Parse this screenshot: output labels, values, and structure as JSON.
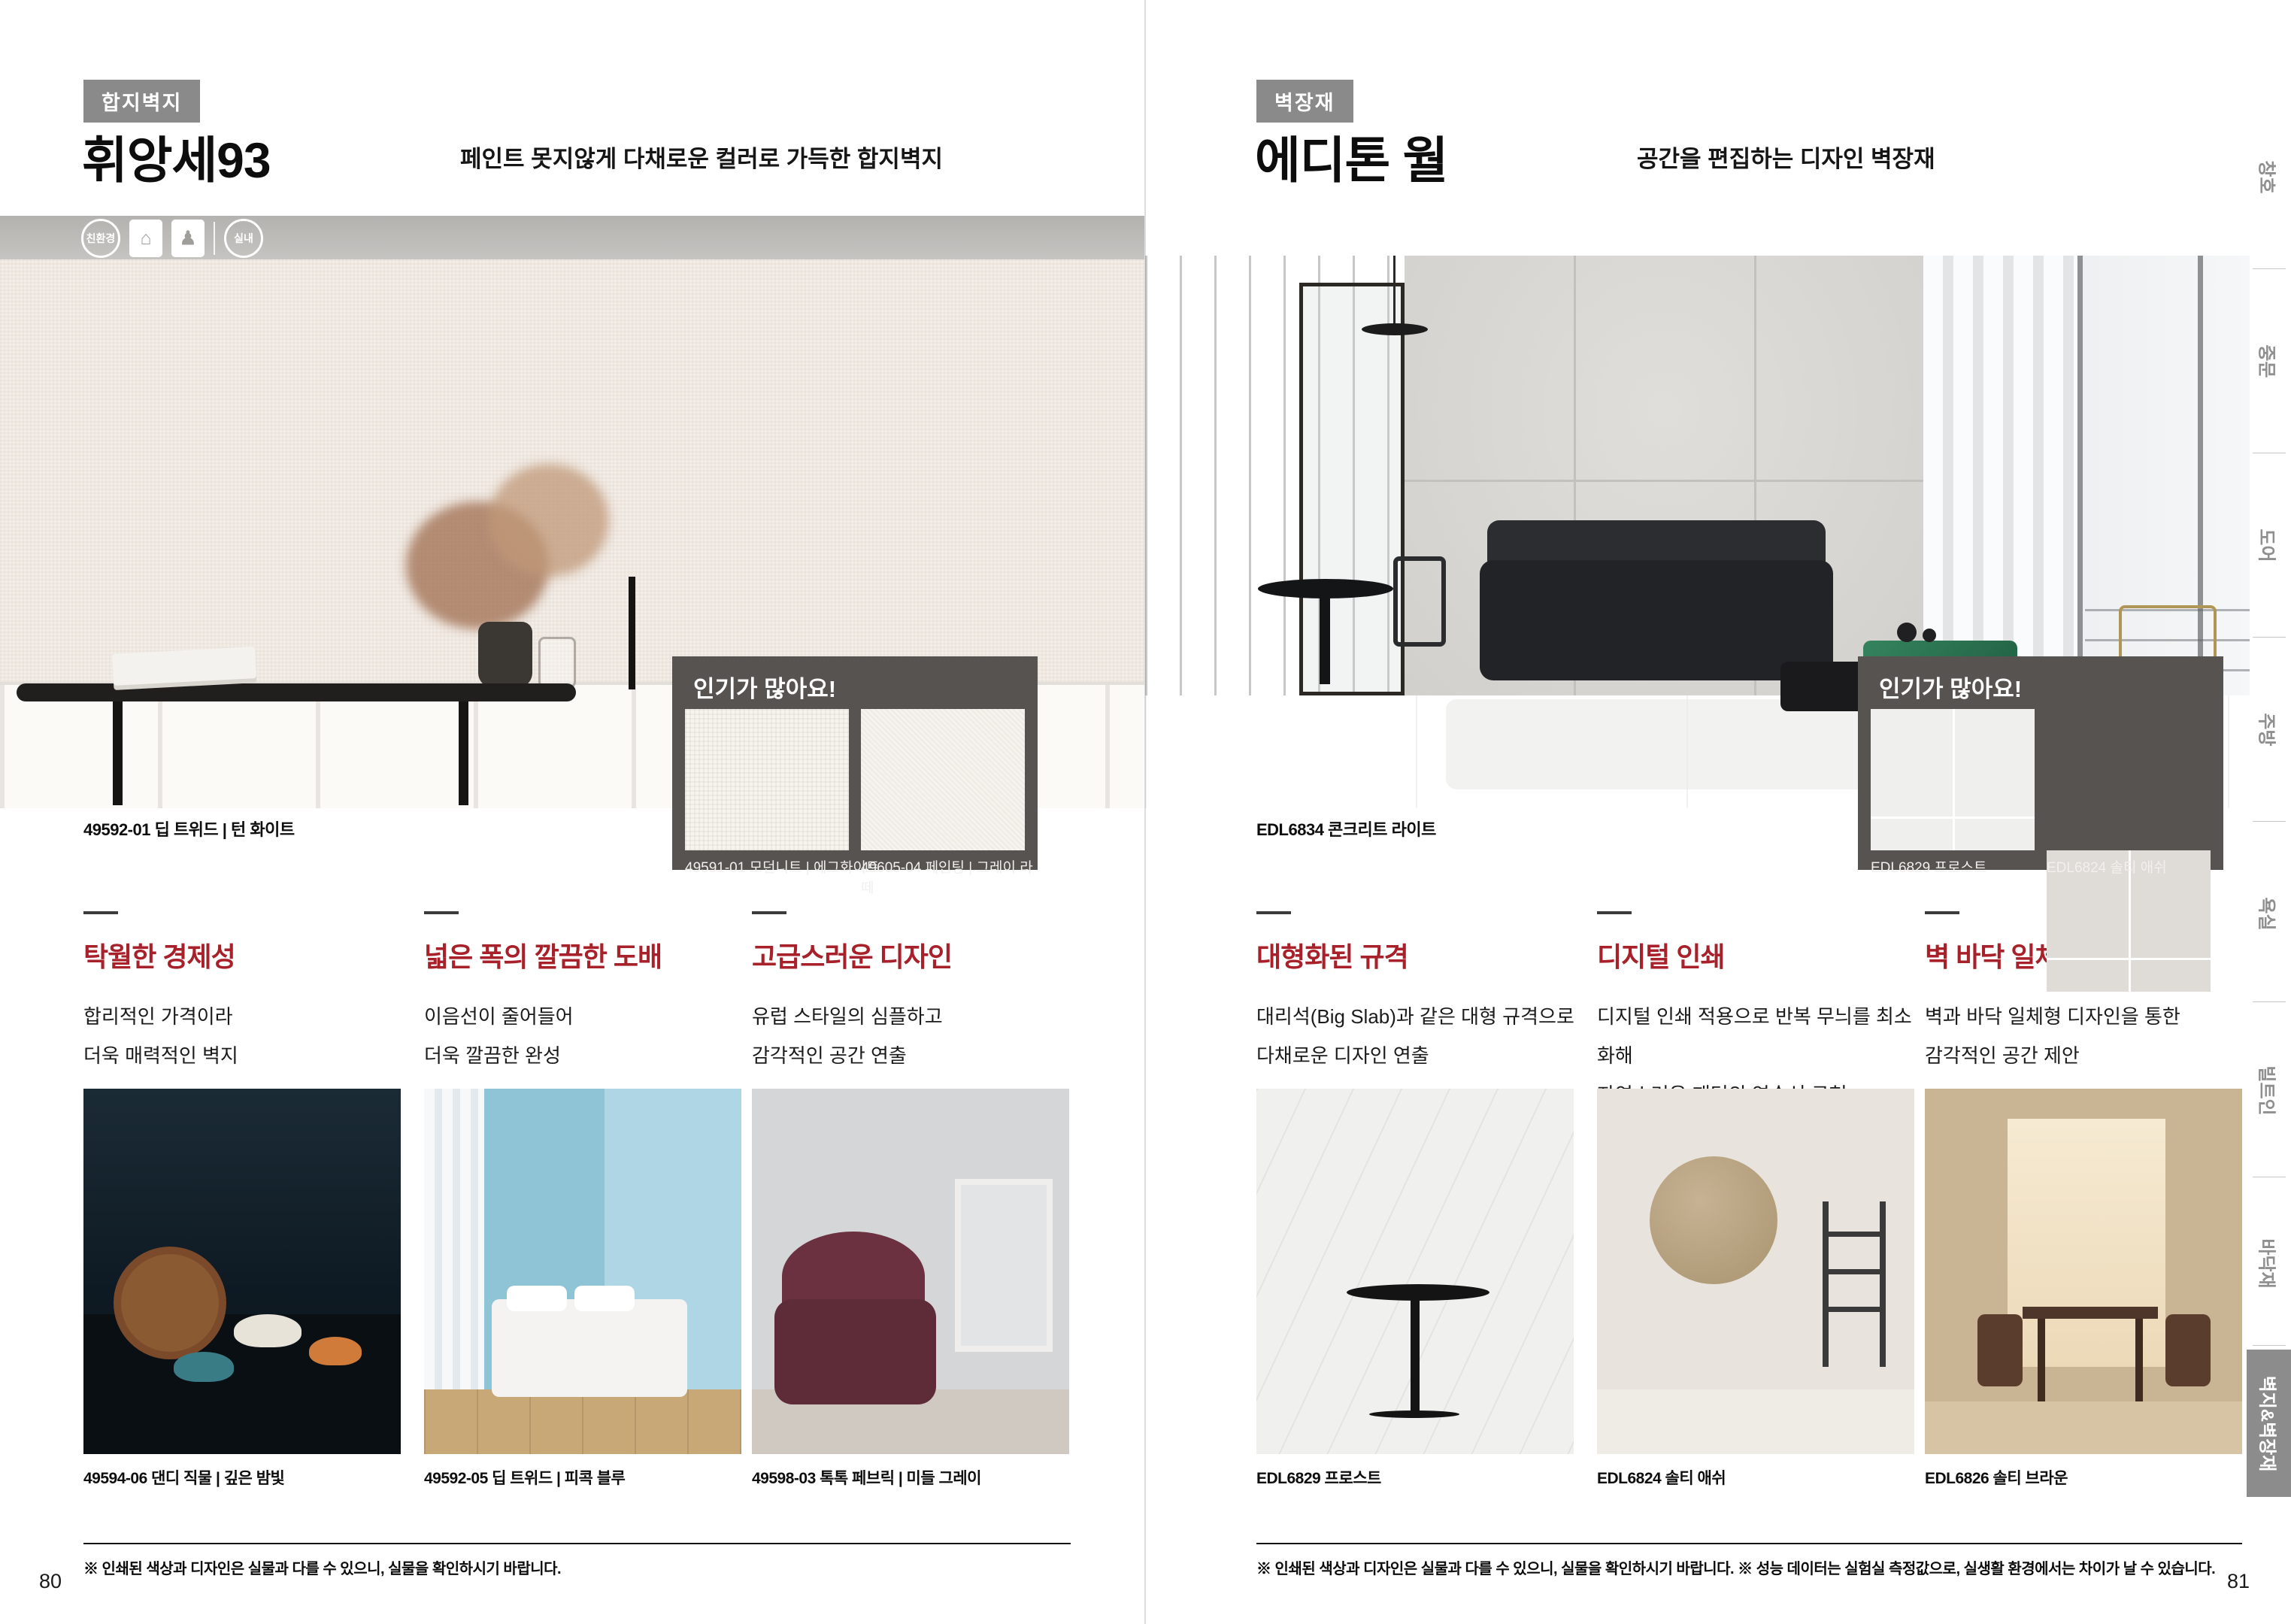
{
  "colors": {
    "accent_red": "#a8212a",
    "badge_gray": "#8a8a8a",
    "popular_box_bg": "#575350",
    "sidebar_active_bg": "#8c8c8c"
  },
  "icons": {
    "eco_house": "⌂",
    "care_person": "♟"
  },
  "pages": {
    "left": {
      "category_badge": "합지벽지",
      "title": "휘앙세93",
      "subtitle": "페인트 못지않게 다채로운 컬러로 가득한 합지벽지",
      "cert_badges": {
        "eco": "친환경",
        "indoor": "실내"
      },
      "hero_caption": "49592-01 딥 트위드 | 턴 화이트",
      "popular": {
        "title": "인기가 많아요!",
        "items": [
          {
            "label": "49591-01 모던니트 | 에그화이트"
          },
          {
            "label": "49605-04 페인팅 | 그레이 라떼"
          }
        ]
      },
      "features": [
        {
          "heading": "탁월한 경제성",
          "line1": "합리적인 가격이라",
          "line2": "더욱 매력적인 벽지"
        },
        {
          "heading": "넓은 폭의 깔끔한 도배",
          "line1": "이음선이 줄어들어",
          "line2": "더욱 깔끔한 완성"
        },
        {
          "heading": "고급스러운 디자인",
          "line1": "유럽 스타일의 심플하고",
          "line2": "감각적인 공간 연출"
        }
      ],
      "products": [
        {
          "caption": "49594-06 댄디 직물 | 깊은 밤빛"
        },
        {
          "caption": "49592-05 딥 트위드 | 피콕 블루"
        },
        {
          "caption": "49598-03 톡톡 페브릭 | 미들 그레이"
        }
      ],
      "footnote": "※ 인쇄된 색상과 디자인은 실물과 다를 수 있으니, 실물을 확인하시기 바랍니다.",
      "page_number": "80"
    },
    "right": {
      "category_badge": "벽장재",
      "title": "에디톤 월",
      "subtitle": "공간을 편집하는 디자인 벽장재",
      "hero_caption": "EDL6834 콘크리트 라이트",
      "popular": {
        "title": "인기가 많아요!",
        "items": [
          {
            "label": "EDL6829 프로스트"
          },
          {
            "label": "EDL6824 솔티 애쉬"
          }
        ]
      },
      "features": [
        {
          "heading": "대형화된 규격",
          "line1": "대리석(Big Slab)과 같은 대형 규격으로",
          "line2": "다채로운 디자인 연출"
        },
        {
          "heading": "디지털 인쇄",
          "line1": "디지털 인쇄 적용으로 반복 무늬를 최소화해",
          "line2": "자연스러운 패턴의 연속성 구현"
        },
        {
          "heading": "벽 바닥 일체형 디자인",
          "line1": "벽과 바닥 일체형 디자인을 통한",
          "line2": "감각적인 공간 제안"
        }
      ],
      "products": [
        {
          "caption": "EDL6829 프로스트"
        },
        {
          "caption": "EDL6824 솔티 애쉬"
        },
        {
          "caption": "EDL6826 솔티 브라운"
        }
      ],
      "footnote": "※ 인쇄된 색상과 디자인은 실물과 다를 수 있으니, 실물을 확인하시기 바랍니다. ※ 성능 데이터는 실험실 측정값으로, 실생활 환경에서는 차이가 날 수 있습니다.",
      "page_number": "81"
    }
  },
  "sidebar": {
    "tabs": [
      "창호",
      "중문",
      "도어",
      "주방",
      "욕실",
      "빌트인",
      "바닥재",
      "벽지&벽장재"
    ],
    "active_tab": "벽지&벽장재"
  }
}
